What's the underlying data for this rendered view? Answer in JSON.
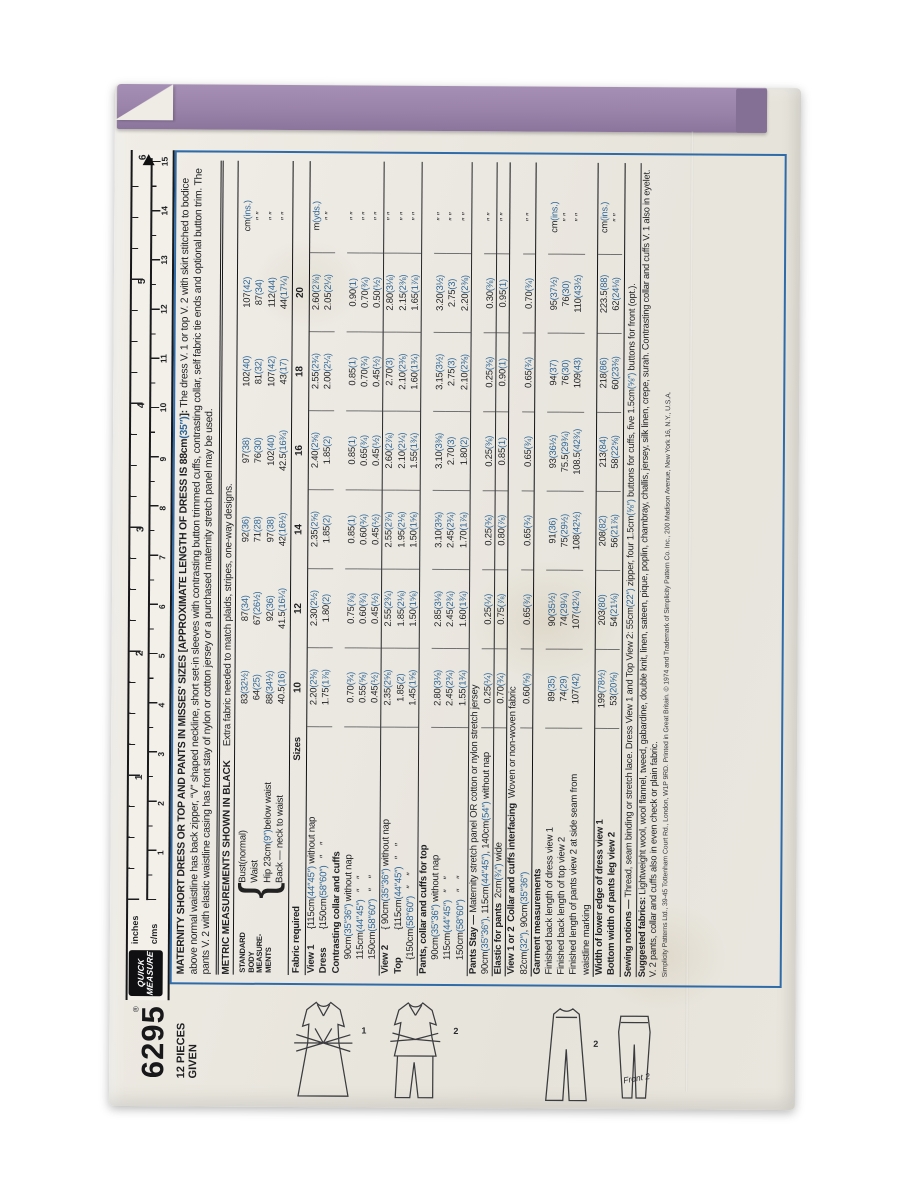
{
  "colors": {
    "paper": "#eae7df",
    "flap_purple": "#9a83a9",
    "accent_blue": "#2d6596",
    "rule_blue": "#2f6ba8",
    "ink": "#1f1f22"
  },
  "sidebar": {
    "number": "6295",
    "pieces_line1": "12 PIECES",
    "pieces_line2": "GIVEN"
  },
  "ruler": {
    "reg": "®",
    "brand_line1": "QUICK",
    "brand_line2": "MEASURE",
    "unit_top": "inches",
    "unit_bottom": "c/ms",
    "inch_numbers": [
      "1",
      "2",
      "3",
      "4",
      "5",
      "6"
    ],
    "cm_numbers": [
      "1",
      "2",
      "3",
      "4",
      "5",
      "6",
      "7",
      "8",
      "9",
      "10",
      "11",
      "12",
      "13",
      "14",
      "15"
    ]
  },
  "headline": {
    "bold": "MATERNITY SHORT DRESS OR TOP AND PANTS IN MISSES' SIZES [APPROXIMATE LENGTH OF DRESS IS 88cm(35″)]:",
    "text": " The dress V. 1 or top V. 2 with skirt stitched to bodice above normal waistline has back zipper, “V” shaped neckline, short set-in sleeves with contrasting button trimmed cuffs, contrasting collar, self fabric tie ends and optional button trim. The pants V. 2 with elastic waistline casing has front stay of nylon or cotton jersey or a purchased maternity stretch panel may be used."
  },
  "metric_line": {
    "bold": "METRIC MEASUREMENTS SHOWN IN BLACK",
    "normal": "Extra fabric needed to match plaids, stripes, one-way designs."
  },
  "body_side_label": [
    "STANDARD",
    "BODY",
    "MEASURE-",
    "MENTS"
  ],
  "body_rows": [
    {
      "label": "Bust(normal)",
      "values": [
        "83(32½)",
        "87(34)",
        "92(36)",
        "97(38)",
        "102(40)",
        "107(42)"
      ],
      "unit": "cm(ins.)"
    },
    {
      "label": "Waist",
      "values": [
        "64(25)",
        "67(26½)",
        "71(28)",
        "76(30)",
        "81(32)",
        "87(34)"
      ],
      "unit": "″    ″"
    },
    {
      "label": "Hip 23cm(9″)below waist",
      "values": [
        "88(34½)",
        "92(36)",
        "97(38)",
        "102(40)",
        "107(42)",
        "112(44)"
      ],
      "unit": "″    ″"
    },
    {
      "label": "Back — neck to waist",
      "values": [
        "40.5(16)",
        "41.5(16¼)",
        "42(16½)",
        "42.5(16¾)",
        "43(17)",
        "44(17¼)"
      ],
      "unit": "″    ″"
    }
  ],
  "sizes_header": {
    "left": "Fabric required",
    "word": "Sizes",
    "sizes": [
      "10",
      "12",
      "14",
      "16",
      "18",
      "20"
    ]
  },
  "table_rows": [
    {
      "head": "View 1",
      "label": "{115cm(44″45″) without nap",
      "values": [
        "2.20(2⅜)",
        "2.30(2½)",
        "2.35(2⅝)",
        "2.40(2⅝)",
        "2.55(2¾)",
        "2.60(2⅞)"
      ],
      "unit": "m(yds.)",
      "lines": true
    },
    {
      "head": "Dress",
      "label": "{150cm(58″60″)   ″    ″",
      "values": [
        "1.75(1⅞)",
        "1.80(2)",
        "1.85(2)",
        "1.85(2)",
        "2.00(2¼)",
        "2.05(2¼)"
      ],
      "unit": "″    ″",
      "lines": true
    },
    {
      "label": "Contrasting collar and cuffs",
      "bold": true
    },
    {
      "label": "90cm(35″36″) without nap",
      "indent": 1,
      "values": [
        "0.70(¾)",
        "0.75(⅞)",
        "0.85(1)",
        "0.85(1)",
        "0.85(1)",
        "0.90(1)"
      ],
      "unit": "″    ″",
      "lines": true
    },
    {
      "label": "115cm(44″45″)   ″    ″",
      "indent": 1,
      "values": [
        "0.55(⅝)",
        "0.60(¾)",
        "0.60(¾)",
        "0.65(¾)",
        "0.70(¾)",
        "0.70(¾)"
      ],
      "unit": "″    ″",
      "lines": true
    },
    {
      "label": "150cm(58″60″)   ″    ″",
      "indent": 1,
      "values": [
        "0.45(½)",
        "0.45(½)",
        "0.45(½)",
        "0.45(½)",
        "0.45(½)",
        "0.50(½)"
      ],
      "unit": "″    ″",
      "lines": true
    },
    {
      "head": "View 2",
      "label": "{ 90cm(35″36″) without nap",
      "top": "thin",
      "values": [
        "2.35(2⅝)",
        "2.55(2¾)",
        "2.55(2⅞)",
        "2.60(2⅞)",
        "2.70(3)",
        "2.80(3⅛)"
      ],
      "unit": "″    ″",
      "lines": true
    },
    {
      "head": "Top",
      "label": "{115cm(44″45″)   ″    ″",
      "values": [
        "1.85(2)",
        "1.85(2⅛)",
        "1.95(2⅛)",
        "2.10(2¼)",
        "2.10(2⅜)",
        "2.15(2⅜)"
      ],
      "unit": "″    ″",
      "lines": true
    },
    {
      "label": "{150cm(58″60″)   ″    ″",
      "indent": 1,
      "values": [
        "1.45(1⅝)",
        "1.50(1⅝)",
        "1.50(1⅝)",
        "1.55(1¾)",
        "1.60(1¾)",
        "1.65(1⅞)"
      ],
      "unit": "″    ″",
      "lines": true
    },
    {
      "label": "Pants, collar and cuffs for top",
      "bold": true,
      "top": "thin"
    },
    {
      "label": "90cm(35″36″) without nap",
      "indent": 1,
      "values": [
        "2.80(3⅛)",
        "2.85(3⅛)",
        "3.10(3⅜)",
        "3.10(3⅜)",
        "3.15(3½)",
        "3.20(3½)"
      ],
      "unit": "″    ″",
      "lines": true
    },
    {
      "label": "115cm(44″45″)   ″    ″",
      "indent": 1,
      "values": [
        "2.45(2¾)",
        "2.45(2¾)",
        "2.45(2¾)",
        "2.70(3)",
        "2.75(3)",
        "2.75(3)"
      ],
      "unit": "″    ″",
      "lines": true
    },
    {
      "label": "150cm(58″60″)   ″    ″",
      "indent": 1,
      "values": [
        "1.55(1¾)",
        "1.60(1¾)",
        "1.70(1⅞)",
        "1.80(2)",
        "2.10(2⅜)",
        "2.20(2⅜)"
      ],
      "unit": "″    ″",
      "lines": true
    },
    {
      "boldlead": "Pants Stay —",
      "label": " Maternity stretch panel OR cotton or nylon stretch jersey",
      "top": "thin"
    },
    {
      "label": "90cm(35″36″), 115cm(44″45″), 140cm(54″) without nap",
      "values": [
        "0.25(¼)",
        "0.25(¼)",
        "0.25(⅜)",
        "0.25(⅜)",
        "0.25(⅜)",
        "0.30(⅜)"
      ],
      "unit": "″    ″",
      "lines": true
    },
    {
      "boldlead": "Elastic for pants",
      "label": "  2cm(¾″) wide",
      "top": "thin",
      "values": [
        "0.70(¾)",
        "0.75(⅞)",
        "0.80(⅞)",
        "0.85(1)",
        "0.90(1)",
        "0.95(1)"
      ],
      "unit": "″    ″",
      "lines": true
    },
    {
      "boldlead": "View 1 or 2  Collar and cuffs interfacing",
      "label": "  Woven or non-woven fabric",
      "top": "thick"
    },
    {
      "label": "82cm(32″), 90cm(35″36″)",
      "values": [
        "0.60(⅝)",
        "0.65(¾)",
        "0.65(¾)",
        "0.65(¾)",
        "0.65(¾)",
        "0.70(¾)"
      ],
      "unit": "″    ″",
      "lines": true
    },
    {
      "label": "Garment measurements",
      "bold": true,
      "top": "thick"
    },
    {
      "label": "Finished back length of dress view 1",
      "values": [
        "89(35)",
        "90(35½)",
        "91(36)",
        "93(36½)",
        "94(37)",
        "95(37½)"
      ],
      "unit": "cm(ins.)",
      "lines": true
    },
    {
      "label": "Finished back length of top view 2",
      "values": [
        "74(29)",
        "74(29¼)",
        "75(29½)",
        "75.5(29¾)",
        "76(30)",
        "76(30)"
      ],
      "unit": "″    ″",
      "lines": true
    },
    {
      "label": "Finished length of pants view 2 at side seam from",
      "values": [
        "107(42)",
        "107(42¼)",
        "108(42½)",
        "108.5(42¾)",
        "109(43)",
        "110(43½)"
      ],
      "unit": "″    ″",
      "lines": true
    },
    {
      "label": "waistline marking"
    },
    {
      "label": "Width of lower edge of dress view 1",
      "bold": true,
      "top": "thick",
      "values": [
        "199(78½)",
        "203(80)",
        "208(82)",
        "213(84)",
        "218(86)",
        "223.5(88)"
      ],
      "unit": "cm(ins.)",
      "lines": true
    },
    {
      "label": "Bottom width of pants leg view 2",
      "bold": true,
      "values": [
        "53(20⅝)",
        "54(21⅛)",
        "56(21⅞)",
        "58(22⅝)",
        "60(23⅜)",
        "62(24⅛)"
      ],
      "unit": "″    ″",
      "lines": true
    }
  ],
  "tail_lines": [
    {
      "lead": "Sewing notions —",
      "text": " Thread, seam binding or stretch lace. Dress View 1 and Top View 2: 55cm(22″) zipper, four 1.5cm(⅝″) buttons for cuffs, five 1.5cm(⅝″) buttons for front (opt.).",
      "top": "thick"
    },
    {
      "lead": "Suggested fabrics:",
      "text": " Lightweight wool, wool flannel, tweed, gabardine, double knit, linen, sateen, pique, poplin, chambray, challis, jersey, silk linen, crepe, surah. Contrasting collar and cuffs V. 1 also in eyelet. V. 2 pants, collar and cuffs also in even check or plain fabric.",
      "top": "thin"
    }
  ],
  "copyright": "Simplicity Patterns Ltd., 39-45 Tottenham Court Rd., London, W1P 9RD.   Printed in Great Britain.   © 1974 and Trademark of Simplicity Pattern Co. Inc., 200 Madison Avenue, New York 16, N.Y., U.S.A.",
  "figures": [
    {
      "label": "1"
    },
    {
      "label": "2"
    },
    {
      "label": "2"
    },
    {
      "label": "Front 2"
    }
  ]
}
